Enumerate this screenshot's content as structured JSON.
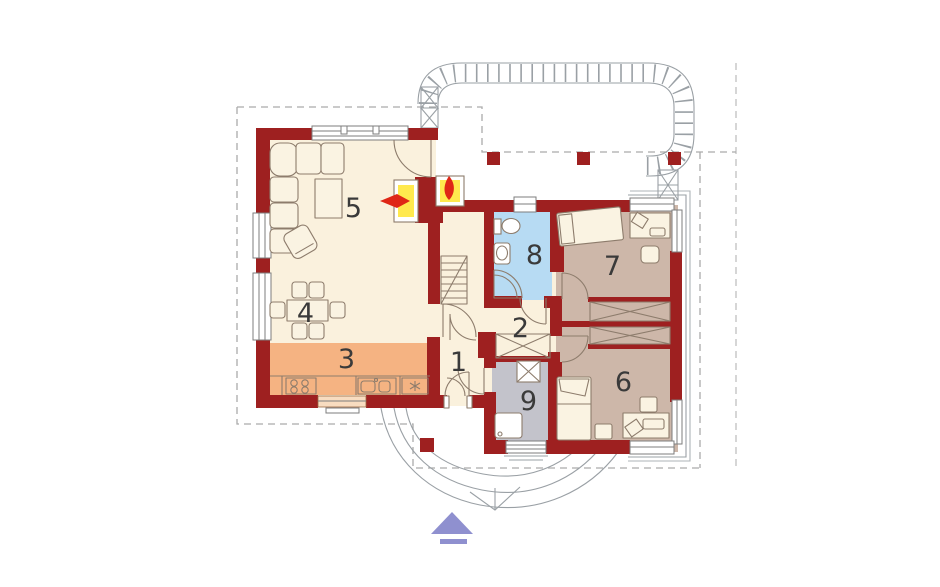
{
  "page": {
    "type": "architectural-floor-plan",
    "background": "#ffffff"
  },
  "colors": {
    "wall": "#9e2020",
    "floor_cream": "#faf1dd",
    "kitchen_orange": "#f5b382",
    "bath_blue": "#b7dbf3",
    "utility_gray": "#c3c3cb",
    "bedroom_tan": "#cdb7a9",
    "wardrobe_fill": "#e9dcc9",
    "fireplace_yellow": "#ffe94e",
    "flame_red": "#df2716",
    "arrow_purple": "#8f90cf",
    "window_white": "#ffffff",
    "outline_brown": "#8d7c6c",
    "site_gray": "#9aa0a5",
    "roof_dash_gray": "#ababab",
    "number_color": "#3a3a3a"
  },
  "rooms": [
    {
      "label": "1",
      "name": "entry-hall",
      "color_key": "floor_cream"
    },
    {
      "label": "2",
      "name": "corridor",
      "color_key": "floor_cream"
    },
    {
      "label": "3",
      "name": "kitchen",
      "color_key": "kitchen_orange"
    },
    {
      "label": "4",
      "name": "dining-area",
      "color_key": "floor_cream"
    },
    {
      "label": "5",
      "name": "living-room",
      "color_key": "floor_cream"
    },
    {
      "label": "6",
      "name": "bedroom",
      "color_key": "bedroom_tan"
    },
    {
      "label": "7",
      "name": "bedroom",
      "color_key": "bedroom_tan"
    },
    {
      "label": "8",
      "name": "bathroom",
      "color_key": "bath_blue"
    },
    {
      "label": "9",
      "name": "utility-room",
      "color_key": "utility_gray"
    }
  ],
  "icons": {
    "fireplace": "two-sided fireplace with flames",
    "entrance_arrow": "purple triangle entrance marker",
    "pergola": "hatched terrace band",
    "wardrobe": "rectangle with X brace"
  }
}
